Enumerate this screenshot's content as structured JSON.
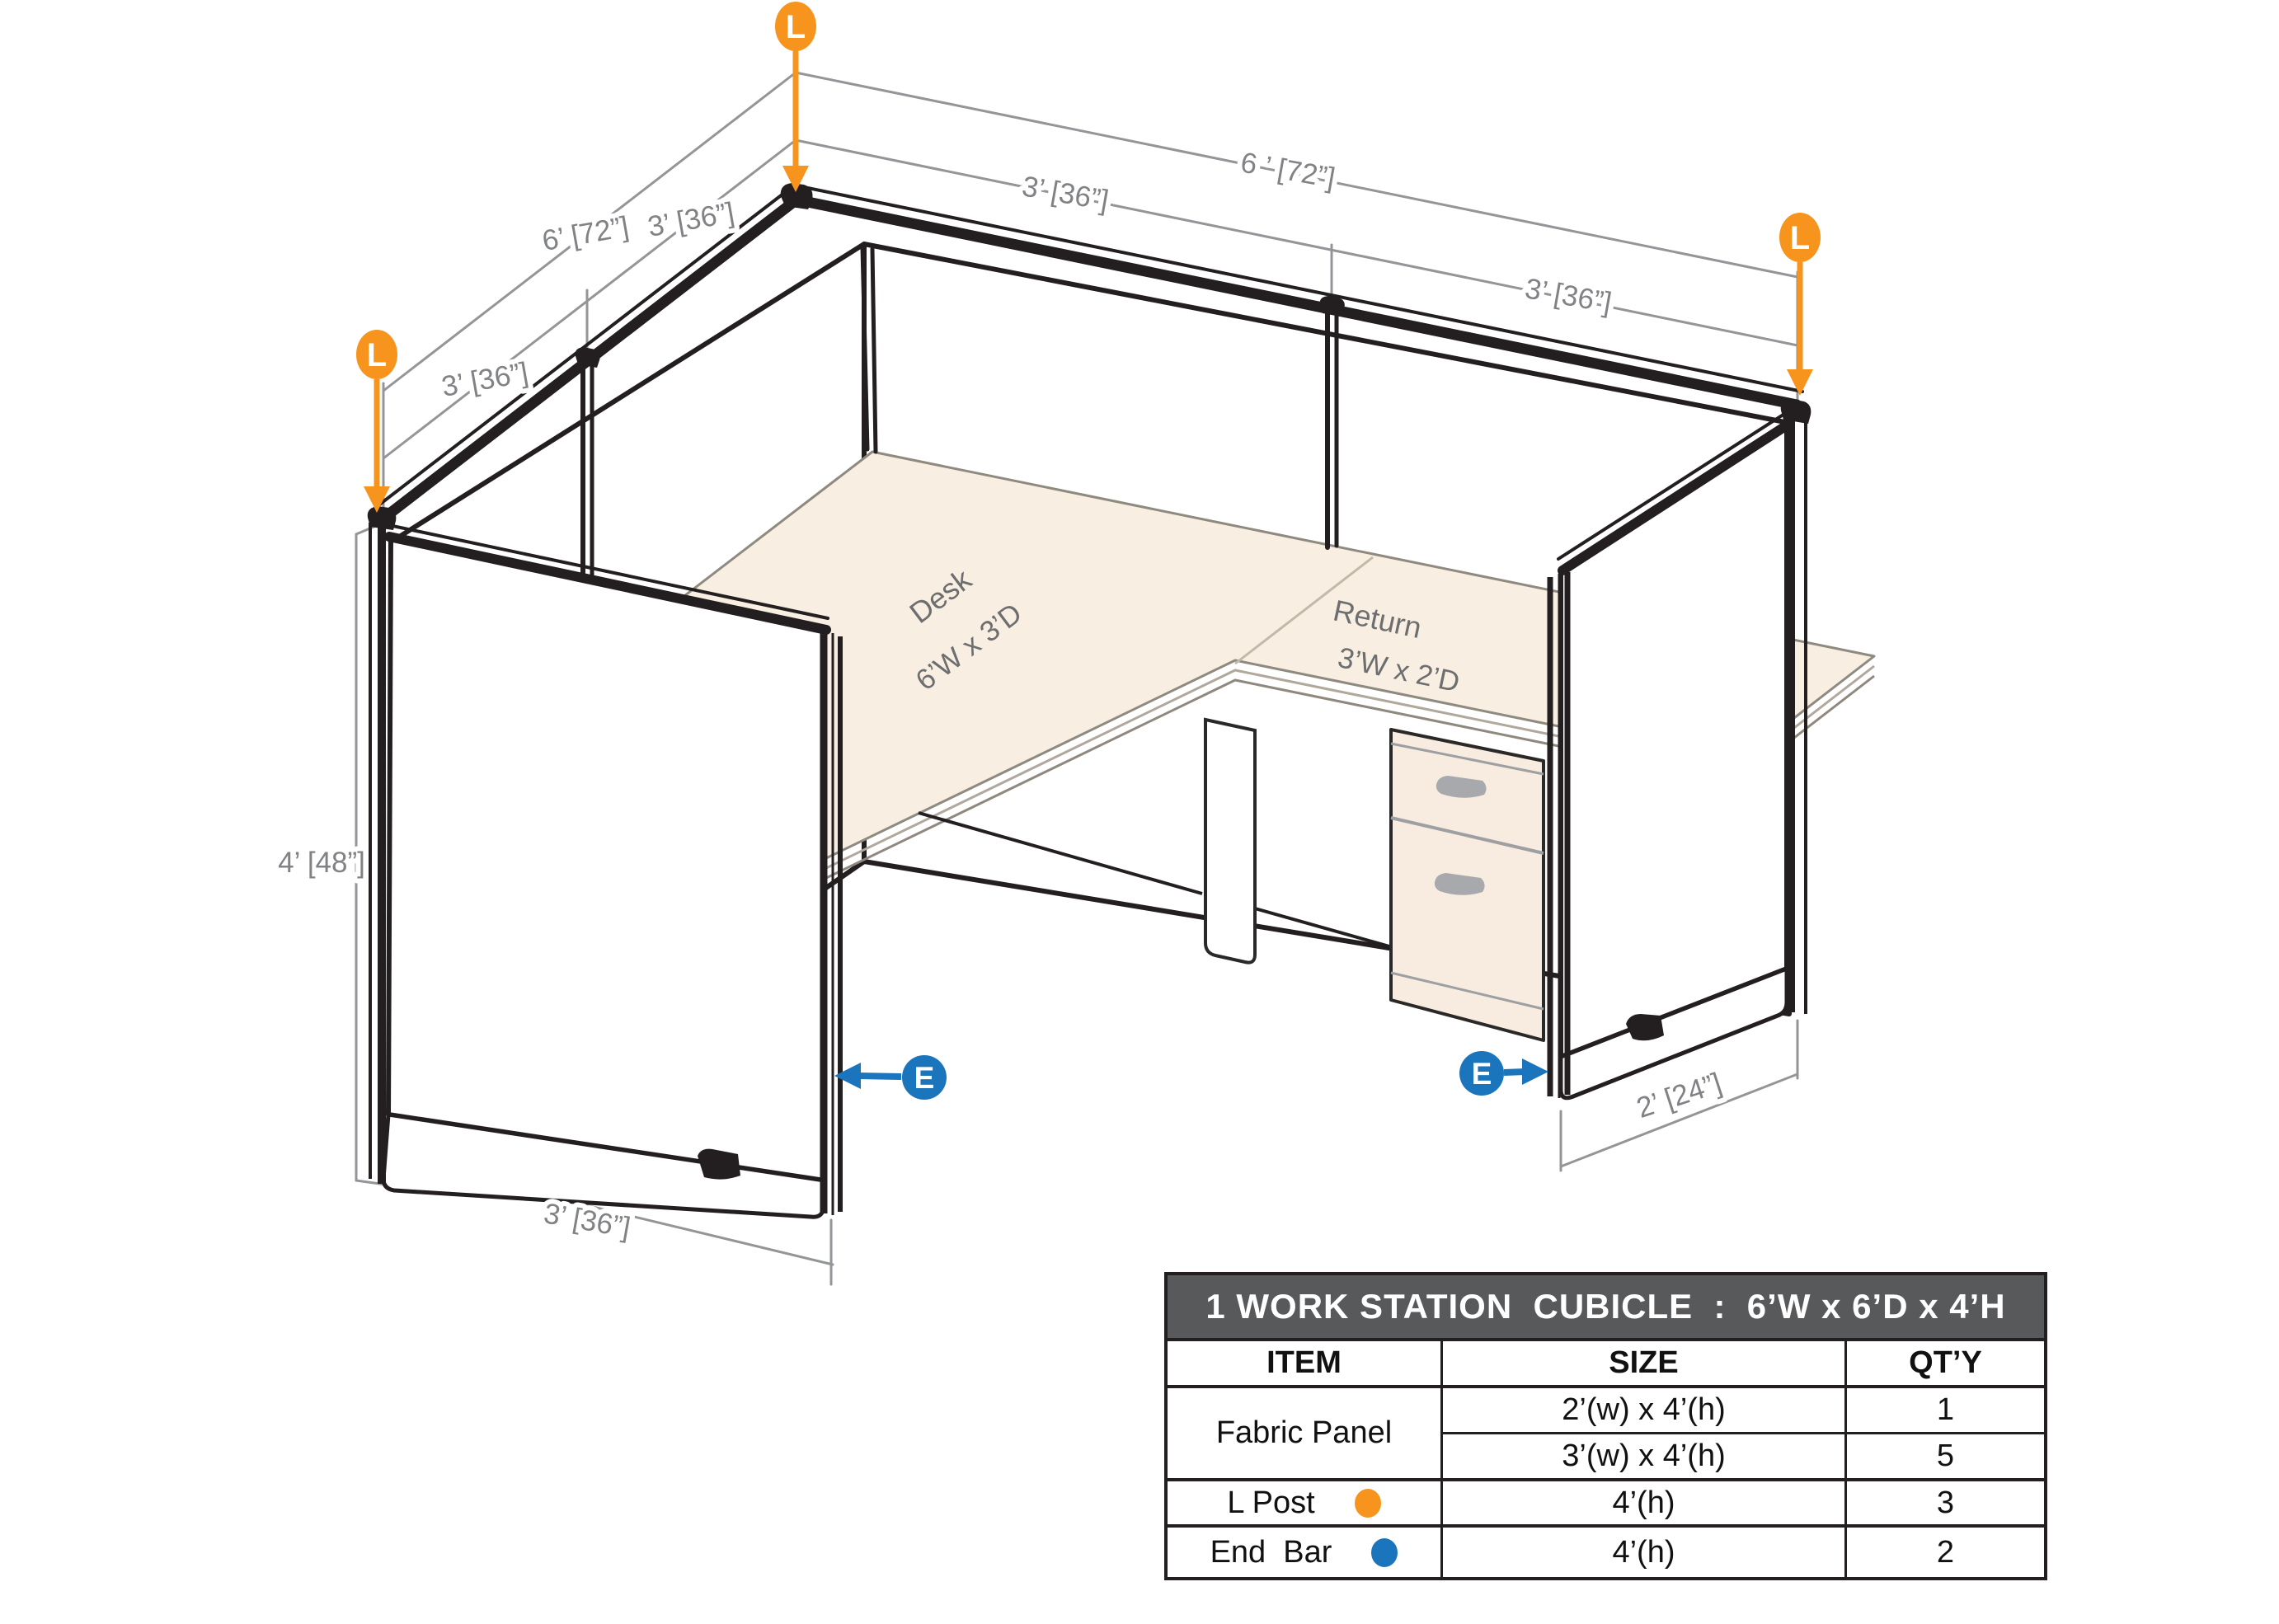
{
  "markers": {
    "l_post": "L",
    "end_bar": "E"
  },
  "desk": {
    "label": "Desk",
    "size": "6’W x 3’D"
  },
  "return_surface": {
    "label": "Return",
    "size": "3’W x 2’D"
  },
  "dimensions": {
    "left_wall_total": "6’ [72”]",
    "left_wall_seg_a": "3’ [36”]",
    "left_wall_seg_b": "3’ [36”]",
    "right_wall_total": "6 ’ [72”]",
    "right_wall_seg_a": "3’ [36”]",
    "right_wall_seg_b": "3’ [36”]",
    "panel_height": "4’ [48”]",
    "front_left_width": "3’ [36”]",
    "front_right_depth": "2’ [24”]"
  },
  "table": {
    "title": "1 WORK STATION  CUBICLE  :  6’W x 6’D x 4’H",
    "headers": {
      "item": "ITEM",
      "size": "SIZE",
      "qty": "QT’Y"
    },
    "rows": {
      "fabric_panel": {
        "item": "Fabric Panel",
        "sizes": [
          {
            "size": "2’(w) x 4’(h)",
            "qty": "1"
          },
          {
            "size": "3’(w) x 4’(h)",
            "qty": "5"
          }
        ]
      },
      "l_post": {
        "item": "L Post",
        "size": "4’(h)",
        "qty": "3"
      },
      "end_bar": {
        "item": "End  Bar",
        "size": "4’(h)",
        "qty": "2"
      }
    }
  },
  "colors": {
    "l_post_orange": "#F7941E",
    "end_bar_blue": "#1B75BC",
    "table_header_gray": "#58595B",
    "desk_beige": "#F8EEE1",
    "line_black": "#231F20",
    "dimension_gray": "#939598"
  }
}
